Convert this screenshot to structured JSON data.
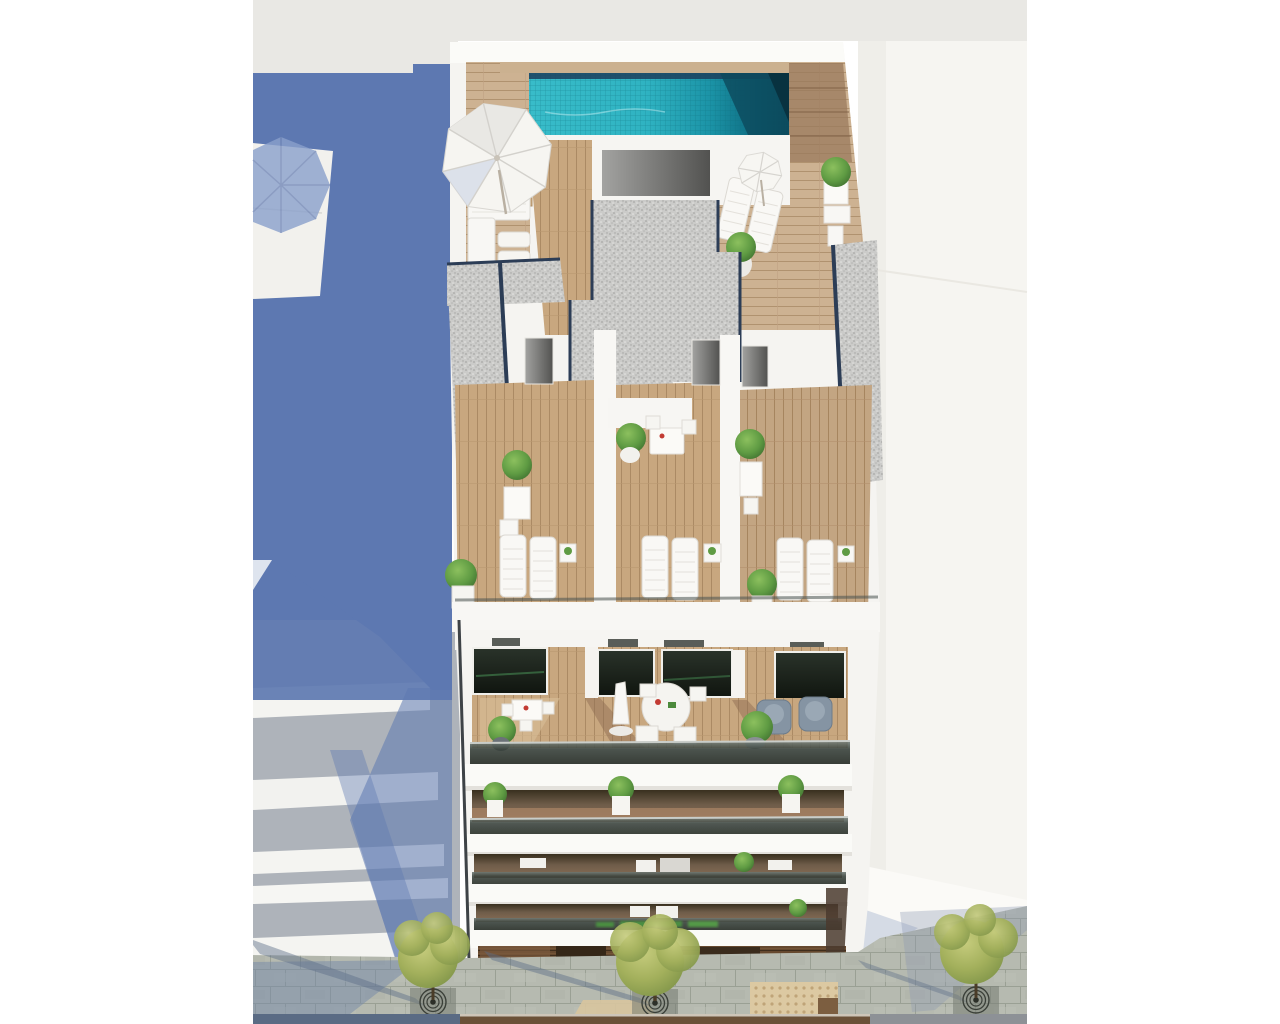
{
  "scene": {
    "description": "Aerial 3D architectural render of a white apartment building: rooftop infinity pool with wooden deck, parasols and loungers, gravel roof strips, three private sun terraces with loungers and planters, four balcony floors with glass balustrades and outdoor furniture, dark wood storefront at street level, paved sidewalk with three trees in circular grates, tactile paving square, long blue cast shadow on the left and neighbouring white buildings on both sides. No legible text anywhere in the image; the small storefront sign is an illegible green blur.",
    "objects": [
      "rooftop-pool",
      "pool-deck",
      "large-parasol",
      "small-parasol",
      "corner-sofa",
      "roof-loungers",
      "gravel-roof-strips",
      "stair-bulkhead",
      "terrace-left",
      "terrace-center",
      "terrace-right",
      "terrace-loungers",
      "terrace-planters",
      "balcony-floor-1",
      "dining-set",
      "round-table-set",
      "closed-parasol",
      "gray-armchairs",
      "balcony-plants",
      "glass-balustrades",
      "storefront",
      "blurred-green-sign",
      "sidewalk",
      "street-trees",
      "tree-grates",
      "tactile-paving",
      "cast-shadow",
      "neighbor-building-left",
      "neighbor-building-right"
    ],
    "sign": {
      "legible": false,
      "color": "#4c9b3f"
    }
  },
  "palette": {
    "canvas": "#ffffff",
    "sky_band": "#e9e8e4",
    "shadow_blue": "#5d78b1",
    "shadow_blue_light": "#aebbd8",
    "wall_white": "#f6f5f2",
    "slab_white": "#fafaf7",
    "wall_shade": "#e3e2de",
    "wood_light": "#cdb292",
    "wood_mid": "#b9987a",
    "wood_dark": "#8d6b50",
    "pool_teal": "#2fb5c4",
    "pool_deep": "#0a4f62",
    "pool_edge_navy": "#1c3f5e",
    "gravel": "#cbcbc9",
    "gravel_edge_navy": "#2c3d56",
    "glass_dark": "#2e352f",
    "window_dark": "#131a13",
    "window_green": "#3f7a4a",
    "plant_green": "#5f9b43",
    "tree_olive": "#a9b35f",
    "armchair_gray": "#8594a3",
    "pavement": "#b6bab0",
    "paver_joint": "#9aa094",
    "tactile_tan": "#dcc9a2",
    "storefront_brown": "#66492f",
    "road_blue": "#5a6b84",
    "road_brown": "#6b5138"
  },
  "layout": {
    "image_width": 1280,
    "image_height": 1024,
    "content_left": 253,
    "content_right": 1027
  }
}
